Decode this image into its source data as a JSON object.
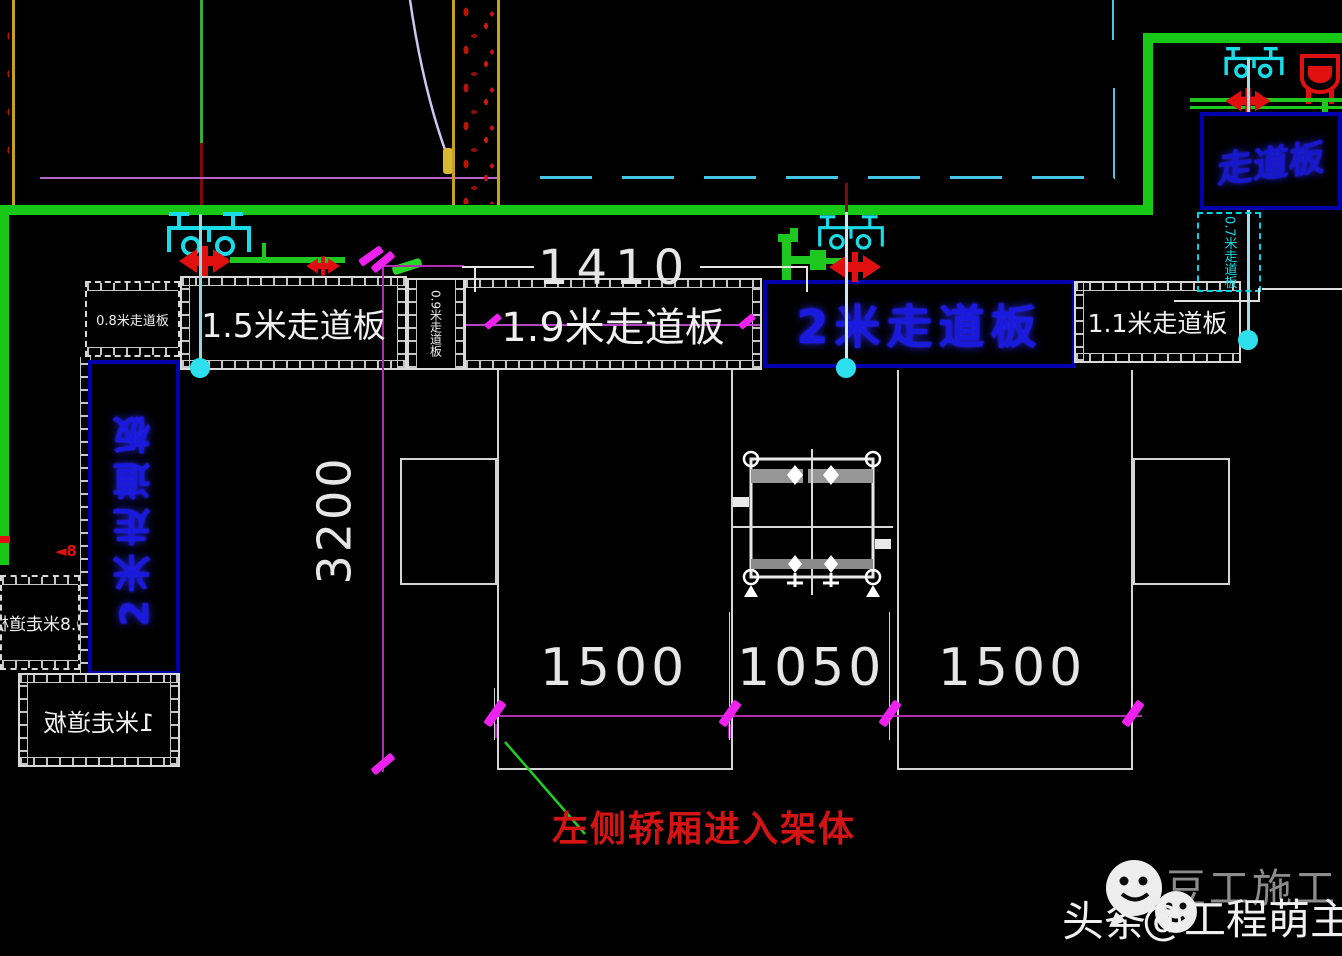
{
  "drawing": {
    "boards": {
      "b08": "0.8米走道板",
      "b15": "1.5米走道板",
      "b09v": "0.9米走道板",
      "b19": "1.9米走道板",
      "b20": "2米走道板",
      "b11": "1.1米走道板",
      "b2v": "2米走道板",
      "b08m": "0.8米走道板",
      "b1m": "1米走道板",
      "b07c": "0.7米走道板"
    },
    "corner": {
      "blue_label": "走道板"
    },
    "dims": {
      "d1410": "1410",
      "d3200": "3200",
      "d1500a": "1500",
      "d1050": "1050",
      "d1500b": "1500"
    },
    "notes": {
      "leader": "左侧轿厢进入架体"
    }
  },
  "watermark": {
    "faded": "豆工施工",
    "prefix": "头条",
    "suffix": "@工程萌主"
  },
  "colors": {
    "background": "#000000",
    "building_green": "#17c817",
    "walkway_white": "#d9d9d9",
    "board_blue_text": "#1a1adf",
    "board_blue_border": "#0000ae",
    "dim_magenta": "#b02db0",
    "tick_magenta": "#ee22ee",
    "note_red": "#d41414",
    "machinery_cyan": "#19dce8",
    "clamp_red": "#e01010",
    "axis_yellow": "#c8a020"
  }
}
